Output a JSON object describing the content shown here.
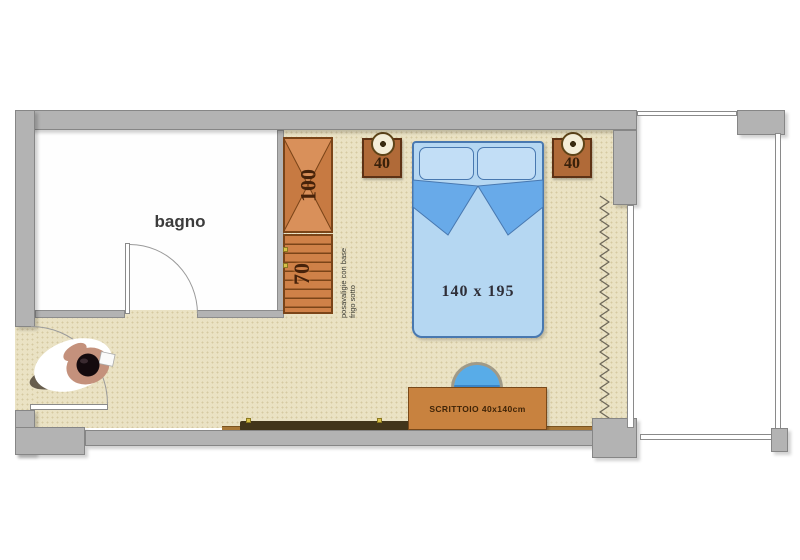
{
  "labels": {
    "bathroom": "bagno",
    "wardrobe": "100",
    "luggage_rack": "70",
    "note_line1": "posavaligie con base",
    "note_line2": "frigo sotto",
    "nightstand_left": "40",
    "nightstand_right": "40",
    "bed": "140 x 195",
    "desk": "SCRITTOIO 40x140cm"
  },
  "colors": {
    "wall": "#b3b3b3",
    "floor": "#eae2c4",
    "bathroom_floor": "#fefefe",
    "wardrobe_wood": "#d0834c",
    "wood_edge": "#7a4418",
    "nightstand": "#b06a38",
    "bed_fill": "#b5d7f2",
    "bed_fold": "#68aae9",
    "bed_edge": "#4878b0",
    "desk": "#c8823f",
    "stool": "#58ace8",
    "radiator": "#42351a",
    "curtain": "#6e685a"
  }
}
